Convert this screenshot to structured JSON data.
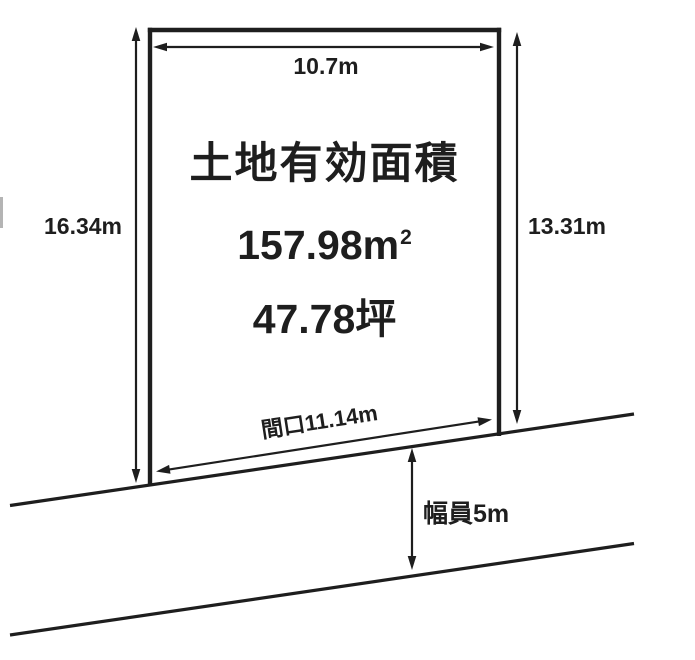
{
  "colors": {
    "ink": "#1e1e1e",
    "background": "#ffffff",
    "edge_artifact": "#b4b4b4"
  },
  "dimensions": {
    "top_width": "10.7m",
    "left_depth": "16.34m",
    "right_depth": "13.31m",
    "frontage": "間口11.14m",
    "road_width": "幅員5m"
  },
  "parcel": {
    "heading": "土地有効面積",
    "area_m2_value": "157.98m",
    "area_m2_sup": "2",
    "area_tsubo": "47.78坪"
  }
}
